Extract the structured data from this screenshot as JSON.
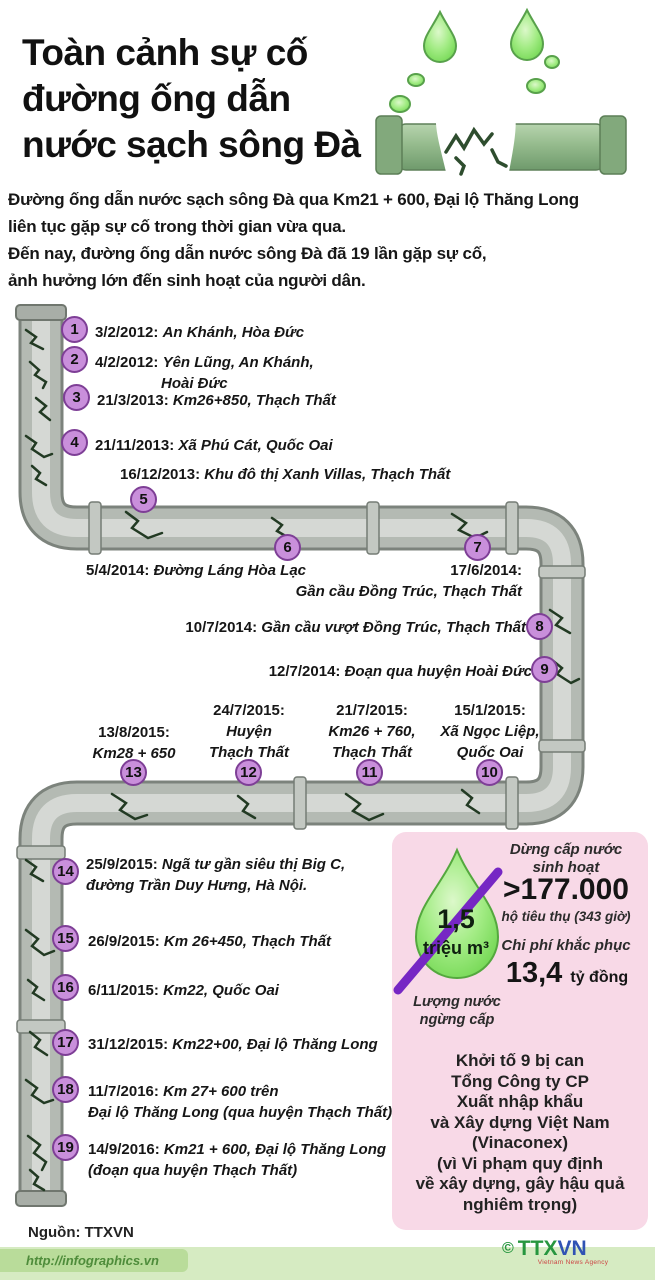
{
  "header": {
    "title": "Toàn cảnh sự cố\nđường ống dẫn\nnước sạch sông Đà"
  },
  "intro": "Đường ống dẫn nước sạch sông Đà qua Km21 + 600, Đại lộ Thăng Long\nliên tục gặp sự cố trong thời gian vừa qua.\nĐến nay, đường ống dẫn nước sông Đà đã 19 lần gặp sự cố,\nảnh hưởng lớn đến sinh hoạt của người dân.",
  "events": [
    {
      "n": "1",
      "date": "3/2/2012:",
      "loc": "An Khánh, Hòa Đức"
    },
    {
      "n": "2",
      "date": "4/2/2012:",
      "loc": "Yên Lũng, An Khánh,",
      "loc2": "Hoài Đức"
    },
    {
      "n": "3",
      "date": "21/3/2013:",
      "loc": "Km26+850, Thạch Thất"
    },
    {
      "n": "4",
      "date": "21/11/2013:",
      "loc": "Xã Phú Cát, Quốc Oai"
    },
    {
      "n": "5",
      "date": "16/12/2013:",
      "loc": "Khu đô thị Xanh Villas, Thạch Thất"
    },
    {
      "n": "6",
      "date": "5/4/2014:",
      "loc": "Đường Láng Hòa Lạc"
    },
    {
      "n": "7",
      "date": "17/6/2014:",
      "loc": "Gần cầu Đồng Trúc, Thạch Thất"
    },
    {
      "n": "8",
      "date": "10/7/2014:",
      "loc": "Gần cầu vượt Đồng Trúc, Thạch Thất"
    },
    {
      "n": "9",
      "date": "12/7/2014:",
      "loc": "Đoạn qua huyện Hoài Đức"
    },
    {
      "n": "10",
      "date": "15/1/2015:",
      "loc": "Xã Ngọc Liệp, Quốc Oai"
    },
    {
      "n": "11",
      "date": "21/7/2015:",
      "loc": "Km26 + 760, Thạch Thất"
    },
    {
      "n": "12",
      "date": "24/7/2015:",
      "loc": "Huyện Thạch Thất"
    },
    {
      "n": "13",
      "date": "13/8/2015:",
      "loc": "Km28 + 650"
    },
    {
      "n": "14",
      "date": "25/9/2015:",
      "loc": "Ngã tư gần siêu thị Big C,",
      "loc2": "đường Trần Duy Hưng, Hà Nội."
    },
    {
      "n": "15",
      "date": "26/9/2015:",
      "loc": "Km 26+450, Thạch Thất"
    },
    {
      "n": "16",
      "date": "6/11/2015:",
      "loc": "Km22, Quốc Oai"
    },
    {
      "n": "17",
      "date": "31/12/2015:",
      "loc": "Km22+00, Đại lộ Thăng Long"
    },
    {
      "n": "18",
      "date": "11/7/2016:",
      "loc": "Km 27+ 600 trên",
      "loc2": "Đại lộ Thăng Long (qua huyện Thạch Thất)"
    },
    {
      "n": "19",
      "date": "14/9/2016:",
      "loc": "Km21 + 600, Đại lộ Thăng Long",
      "loc2": "(đoạn qua huyện Thạch Thất)"
    }
  ],
  "stats": {
    "drop_value": "1,5",
    "drop_unit": "triệu m³",
    "drop_caption": "Lượng nước\nngừng cấp",
    "stat1_label": "Dừng cấp nước\nsinh hoạt",
    "stat1_value": ">177.000",
    "stat1_sub": "hộ tiêu thụ (343 giờ)",
    "stat2_label": "Chi phí khắc phục",
    "stat2_value": "13,4",
    "stat2_unit": "tỷ đồng"
  },
  "prosecution": "Khởi tố 9 bị can\nTổng Công ty CP\nXuất nhập khẩu\nvà Xây dựng Việt Nam\n(Vinaconex)\n(vì Vi phạm quy định\nvề xây dựng, gây hậu quả\nnghiêm trọng)",
  "footer": {
    "source": "Nguồn: TTXVN",
    "url": "http://infographics.vn",
    "copyright": "©",
    "logo": {
      "ttx": "TTX",
      "v": "V",
      "n": "N",
      "caption": "Vietnam News Agency"
    }
  },
  "colors": {
    "circle_fill": "#c98fdb",
    "circle_border": "#7e3f96",
    "pink_box": "#f8d9e7",
    "slash_purple": "#7627c4",
    "pipe_gray": "#b4bab3",
    "pipe_edge": "#7c837c",
    "crack_green": "#223a23",
    "drop_green": "#8ce87a",
    "band_green": "#d6ebc2",
    "logo_green": "#27963f",
    "logo_blue": "#3053b4"
  }
}
